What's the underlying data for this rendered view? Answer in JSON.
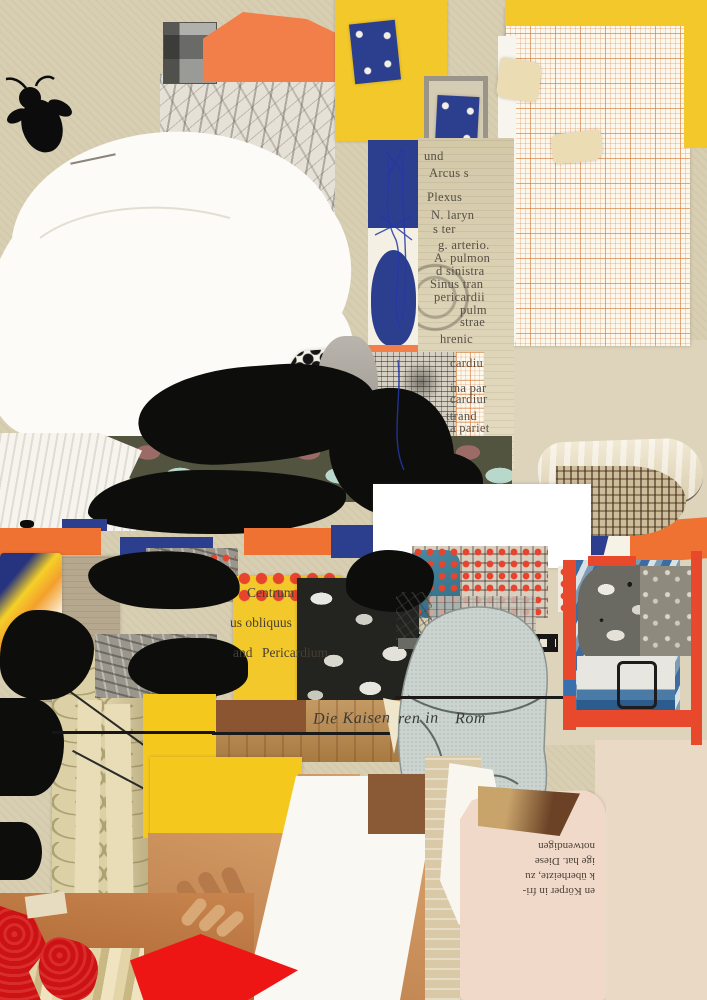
{
  "artwork": {
    "medium": "mixed-media paper collage",
    "palette": {
      "paper_beige": "#d8ceb2",
      "yellow": "#f2c82a",
      "orange": "#ef7233",
      "navy_blue": "#2c3e8e",
      "vermilion_frame": "#e8482b",
      "halftone_red": "#e7432d",
      "skin": "#c98a5a",
      "wood_brown": "#b08048",
      "graph_paper_line": "#d67e3c"
    },
    "anatomy_fragments": [
      {
        "text": "und",
        "x": 424,
        "y": 149
      },
      {
        "text": "Arcus s",
        "x": 429,
        "y": 166
      },
      {
        "text": "Plexus",
        "x": 427,
        "y": 190
      },
      {
        "text": "N. laryn",
        "x": 431,
        "y": 208
      },
      {
        "text": "s ter",
        "x": 433,
        "y": 222
      },
      {
        "text": "g. arterio.",
        "x": 438,
        "y": 238
      },
      {
        "text": "A. pulmon",
        "x": 434,
        "y": 251
      },
      {
        "text": "d sinistra",
        "x": 436,
        "y": 264
      },
      {
        "text": "Sinus tran",
        "x": 430,
        "y": 277
      },
      {
        "text": "pericardii",
        "x": 434,
        "y": 290
      },
      {
        "text": "pulm",
        "x": 460,
        "y": 303
      },
      {
        "text": "strae",
        "x": 460,
        "y": 315
      },
      {
        "text": "hrenic",
        "x": 440,
        "y": 332
      },
      {
        "text": "cardiu",
        "x": 450,
        "y": 356
      },
      {
        "text": "ina par",
        "x": 450,
        "y": 381
      },
      {
        "text": "cardiur",
        "x": 450,
        "y": 392
      },
      {
        "text": "ttrand",
        "x": 446,
        "y": 409
      },
      {
        "text": "a pariet",
        "x": 450,
        "y": 421
      }
    ],
    "yellow_label_fragments": [
      {
        "text": "Centrum",
        "x": 247,
        "y": 585
      },
      {
        "text": "us obliquus",
        "x": 230,
        "y": 615
      },
      {
        "text": "and",
        "x": 233,
        "y": 645
      },
      {
        "text": "Pericardium",
        "x": 262,
        "y": 645
      }
    ],
    "caption_fragments": [
      {
        "text": "Die Kaisen",
        "x": 313,
        "y": 710
      },
      {
        "text": "ren in",
        "x": 398,
        "y": 710
      },
      {
        "text": "Rom",
        "x": 455,
        "y": 710
      }
    ],
    "rotated_text_lines": [
      "en Körper in fri-",
      "k überheizte, zu",
      "ige hat. Diese",
      "notwendigen"
    ]
  }
}
